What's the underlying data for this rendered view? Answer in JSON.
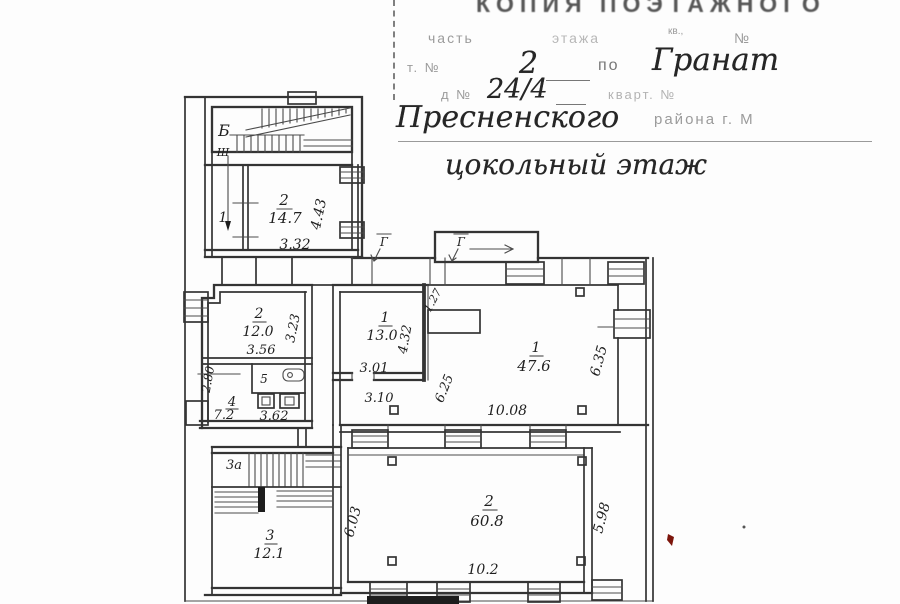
{
  "header": {
    "title": "КОПИЯ ПОЭТАЖНОГО",
    "form_part": "часть",
    "form_floor": "этажа",
    "form_kv": "кв.,",
    "form_no": "№",
    "street_prefix": "т. №",
    "street_number": "2",
    "street_po": "по",
    "street_name": "Гранат",
    "house_prefix": "д №",
    "house_number": "24/4",
    "house_kvart": "кварт. №",
    "district": "Пресненского",
    "district_suffix": "района г. М",
    "floor_title": "цокольный этаж"
  },
  "plan": {
    "stairwell_label": "Б",
    "entry_label": "Ш",
    "marker_left": "Г",
    "marker_right": "Г",
    "room1_upper_num": "1",
    "room2_upper": {
      "num": "2",
      "area": "14.7",
      "width": "3.32",
      "height": "4.43"
    },
    "room2_mid": {
      "num": "2",
      "area": "12.0",
      "width": "3.56",
      "height": "3.23"
    },
    "room5_num": "5",
    "room4": {
      "num": "4",
      "area": "7.2",
      "width": "3.62",
      "height": "2.80"
    },
    "room1_mid": {
      "num": "1",
      "area": "13.0",
      "width": "3.01",
      "height": "4.32"
    },
    "dim_127": "1.27",
    "dim_625": "6.25",
    "dim_310": "3.10",
    "room1_big": {
      "num": "1",
      "area": "47.6",
      "height": "6.35"
    },
    "dim_1008": "10.08",
    "room3a_num": "3а",
    "room3": {
      "num": "3",
      "area": "12.1"
    },
    "room2_big": {
      "num": "2",
      "area": "60.8",
      "width": "10.2",
      "height_left": "6.03",
      "height_right": "5.98"
    }
  }
}
